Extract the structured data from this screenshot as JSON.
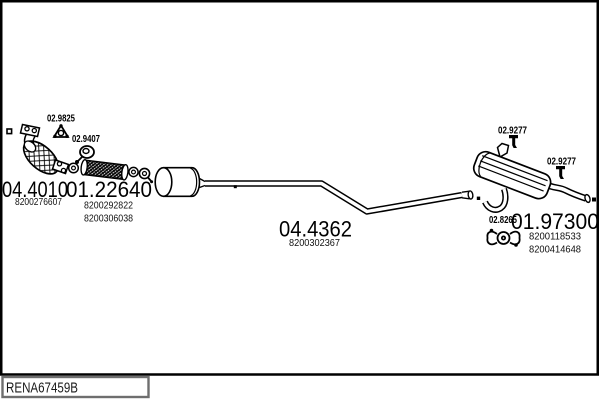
{
  "footer": {
    "code": "RENA67459B"
  },
  "parts": {
    "catalyst": {
      "number": "04.4010",
      "refs": [
        "8200276607"
      ]
    },
    "flex_pipe": {
      "number": "01.22640",
      "refs": [
        "8200292822",
        "8200306038"
      ]
    },
    "centre_silencer": {
      "number": "04.4362",
      "refs": [
        "8200302367"
      ]
    },
    "rear_silencer": {
      "number": "01.97300",
      "refs": [
        "8200118533",
        "8200414648"
      ]
    }
  },
  "fittings": {
    "gasket": "02.9825",
    "front_clamp": "02.9407",
    "hanger_top": "02.9277",
    "hanger_rear": "02.9277",
    "rear_clamp": "02.8265"
  },
  "icons": {
    "gasket": "triangle-gasket-icon",
    "front_clamp": "pipe-clamp-icon",
    "hanger": "rubber-hanger-icon",
    "rear_clamp": "exhaust-clamp-icon",
    "mount": "mount-marker"
  },
  "colors": {
    "line": "#000000",
    "background": "#ffffff",
    "footer_border": "#6e6e6e"
  }
}
